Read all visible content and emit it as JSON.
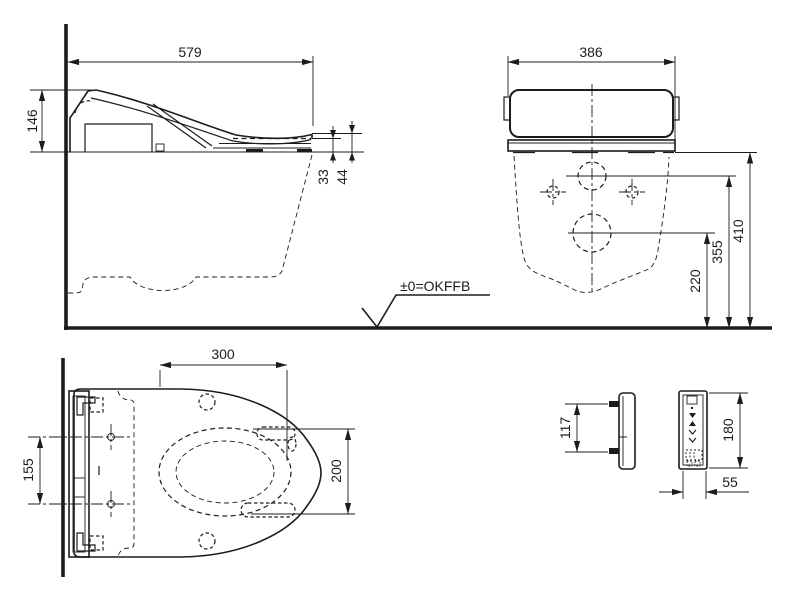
{
  "drawing": {
    "floor_reference_label": "±0=OKFFB",
    "views": {
      "side": {
        "dims": {
          "overall_depth": "579",
          "rear_height": "146",
          "front_seat_thickness": "33",
          "front_lid_thickness": "44"
        }
      },
      "rear": {
        "dims": {
          "overall_width": "386",
          "drain_center_height": "220",
          "inlet_center_height": "355",
          "underside_height": "410"
        }
      },
      "plan": {
        "dims": {
          "opening_length": "300",
          "fixing_hole_spacing": "155",
          "opening_width": "200"
        }
      },
      "remote_side": {
        "dims": {
          "pin_spacing": "117"
        }
      },
      "remote_front": {
        "dims": {
          "height": "180",
          "width": "55"
        }
      }
    }
  }
}
